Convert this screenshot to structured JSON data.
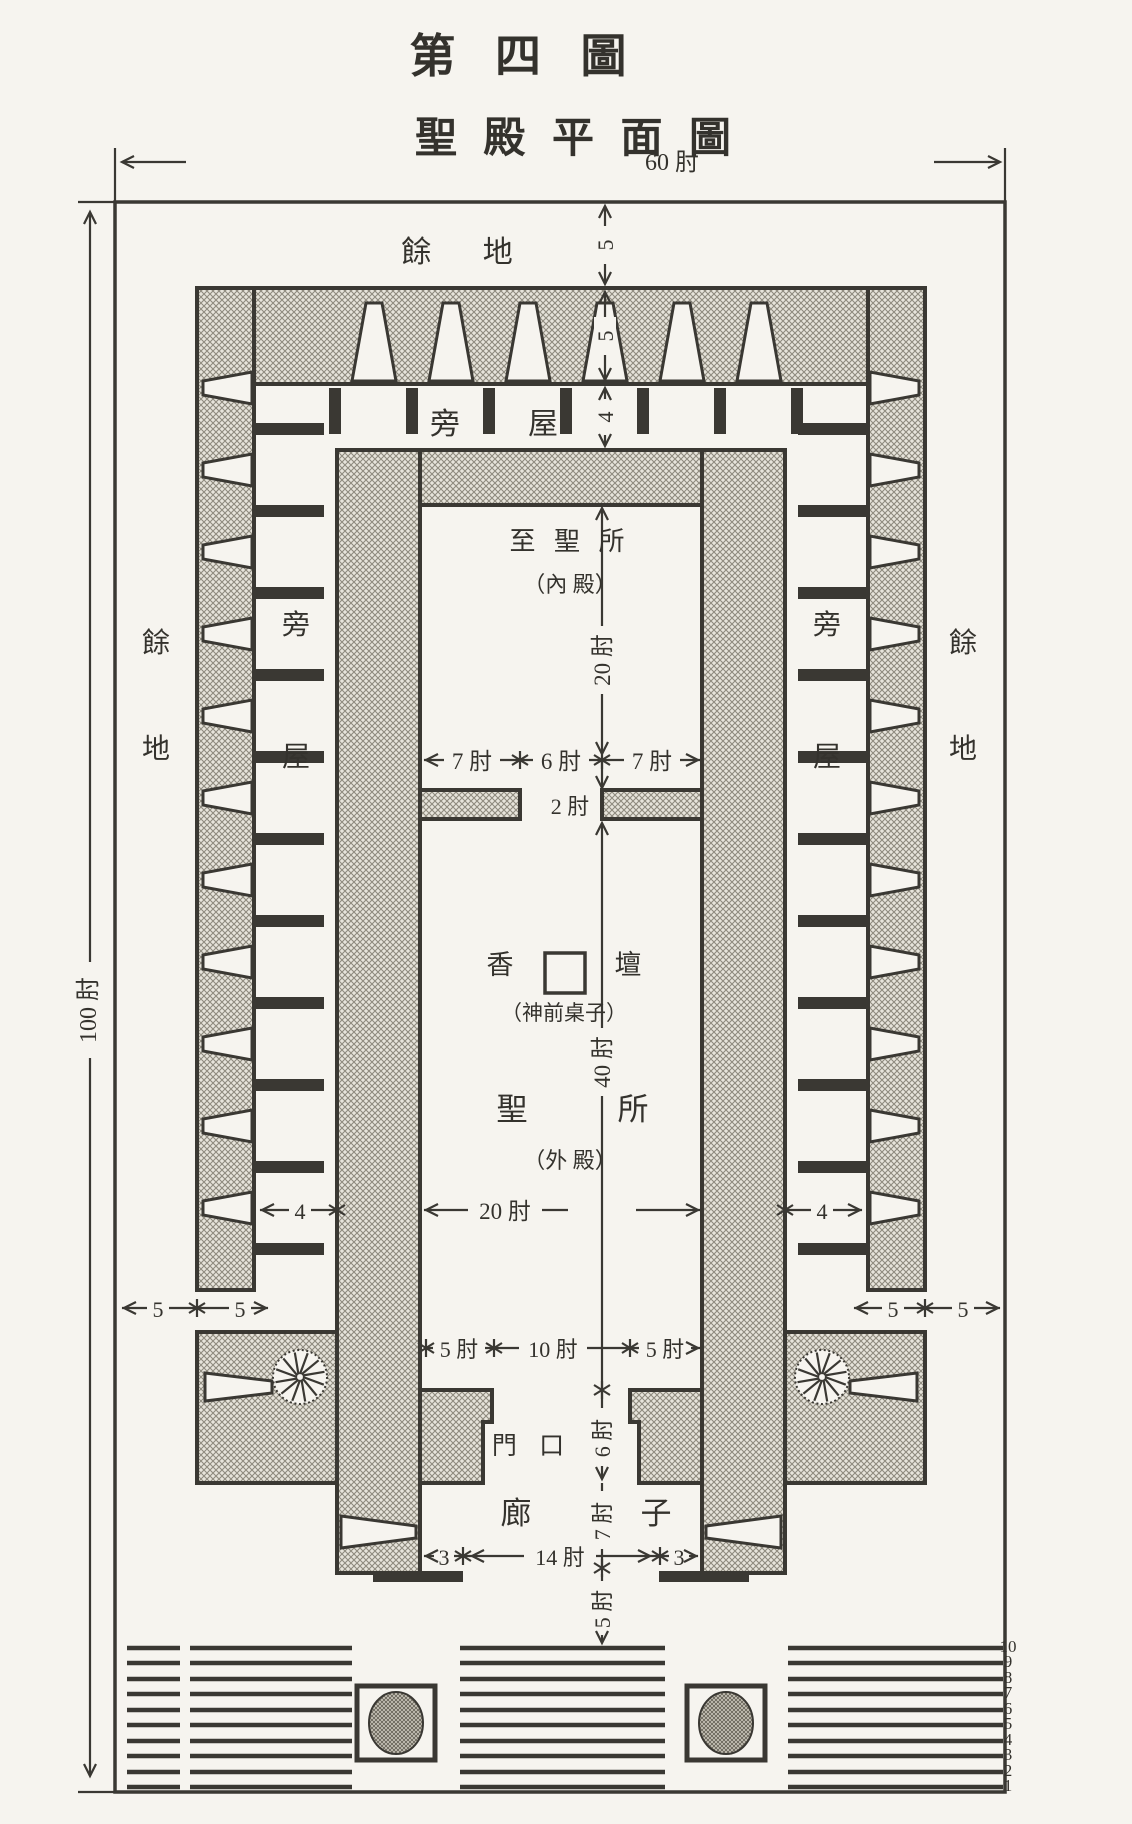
{
  "figure": {
    "title": "第 四 圖",
    "subtitle": "聖 殿 平 面 圖"
  },
  "outer": {
    "width": "60 肘",
    "height": "100 肘"
  },
  "labels": {
    "open_ground_top": "餘 地",
    "open_ground_left": [
      "餘",
      "地"
    ],
    "open_ground_right": [
      "餘",
      "地"
    ],
    "side_rooms_top": [
      "旁",
      "屋"
    ],
    "side_rooms_left": [
      "旁",
      "屋"
    ],
    "side_rooms_right": [
      "旁",
      "屋"
    ],
    "most_holy_place": "至 聖 所",
    "most_holy_place_alt": "（內 殿）",
    "incense_altar": [
      "香",
      "壇"
    ],
    "incense_altar_alt": "（神前桌子）",
    "holy_place": [
      "聖",
      "所"
    ],
    "holy_place_alt": "（外 殿）",
    "doorway": "門 口",
    "porch": [
      "廊",
      "子"
    ]
  },
  "dims": {
    "margin_top": "5",
    "wall_top": "5",
    "rooms_top": "4",
    "most_holy_length": "20 肘",
    "wall_left_len": "7 肘",
    "door_mid": "6 肘",
    "wall_right_len": "7 肘",
    "partition_thick": "2 肘",
    "holy_length": "40 肘",
    "rooms_left_w": "4",
    "holy_width": "20 肘",
    "rooms_right_w": "4",
    "margin_bl_a": "5",
    "margin_bl_b": "5",
    "margin_br_a": "5",
    "margin_br_b": "5",
    "front_wall_left": "5 肘",
    "front_door": "10 肘",
    "front_wall_right": "5 肘",
    "doorway_depth": "6 肘",
    "porch_depth": "7 肘",
    "porch_jamb_left": "3",
    "porch_opening": "14 肘",
    "porch_jamb_right": "3",
    "porch_wall": "5 肘"
  },
  "steps": {
    "numbers": [
      "10",
      "9",
      "8",
      "7",
      "6",
      "5",
      "4",
      "3",
      "2",
      "1"
    ]
  }
}
